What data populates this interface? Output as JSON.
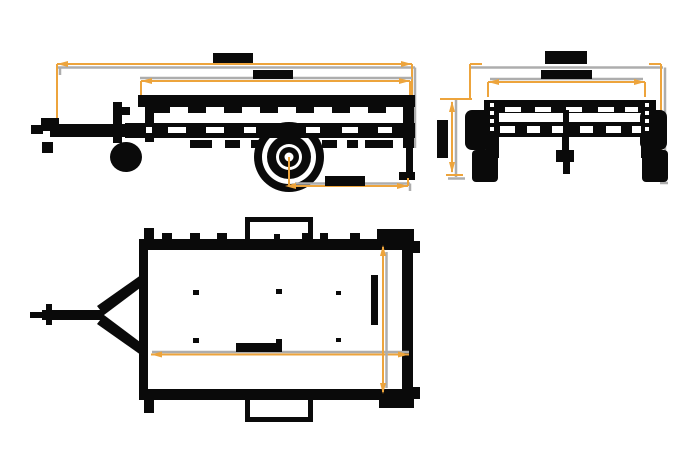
{
  "title": "Utility trailer - three-view technical drawing",
  "colors": {
    "background": "#ffffff",
    "ink": "#0a0a0a",
    "dim_accent": "#eda43c",
    "dim_gray": "#adadad"
  },
  "views": {
    "side": {
      "name": "Side view",
      "dimensions": [
        {
          "id": "overall-length",
          "orientation": "horizontal",
          "label_text": "",
          "label_legible": false
        },
        {
          "id": "bed-length",
          "orientation": "horizontal",
          "label_text": "",
          "label_legible": false
        },
        {
          "id": "axle-to-rear",
          "orientation": "horizontal",
          "label_text": "",
          "label_legible": false
        }
      ]
    },
    "front": {
      "name": "Front view",
      "dimensions": [
        {
          "id": "overall-width",
          "orientation": "horizontal",
          "label_text": "",
          "label_legible": false
        },
        {
          "id": "inner-width",
          "orientation": "horizontal",
          "label_text": "",
          "label_legible": false
        },
        {
          "id": "body-height",
          "orientation": "vertical",
          "label_text": "",
          "label_legible": false
        }
      ]
    },
    "plan": {
      "name": "Top plan view",
      "dimensions": [
        {
          "id": "bed-length",
          "orientation": "horizontal",
          "label_text": "",
          "label_legible": false
        },
        {
          "id": "bed-width",
          "orientation": "vertical",
          "label_text": "",
          "label_legible": false
        }
      ]
    }
  }
}
